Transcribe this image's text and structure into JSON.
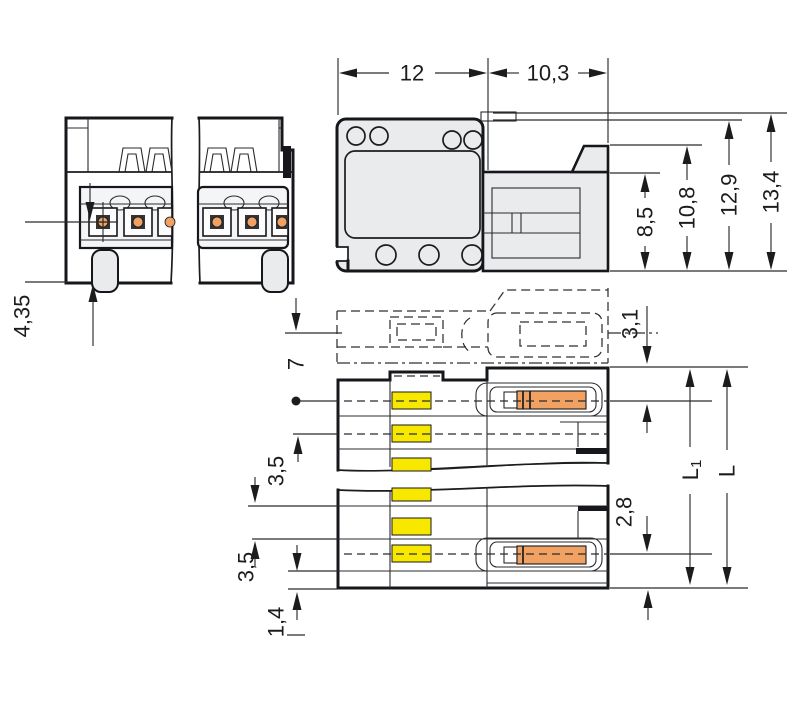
{
  "drawing": {
    "dim_width_main": "12",
    "dim_width_right": "10,3",
    "dim_height_85": "8,5",
    "dim_height_108": "10,8",
    "dim_height_129": "12,9",
    "dim_height_134": "13,4",
    "dim_front_pin_height": "4,35",
    "dim_phantom_offset": "3,1",
    "dim_pin_length": "7",
    "dim_pitch_upper": "3,5",
    "dim_pitch_lower": "3,5",
    "dim_end_offset": "2,8",
    "dim_lip": "1,4",
    "dim_length1_base": "L",
    "dim_length1_sub": "1",
    "dim_length_total": "L"
  },
  "colors": {
    "body_gray": "#e9ebed",
    "coding_yellow": "#f8e800",
    "contact_orange": "#f1a263",
    "line_dark": "#16171a"
  }
}
